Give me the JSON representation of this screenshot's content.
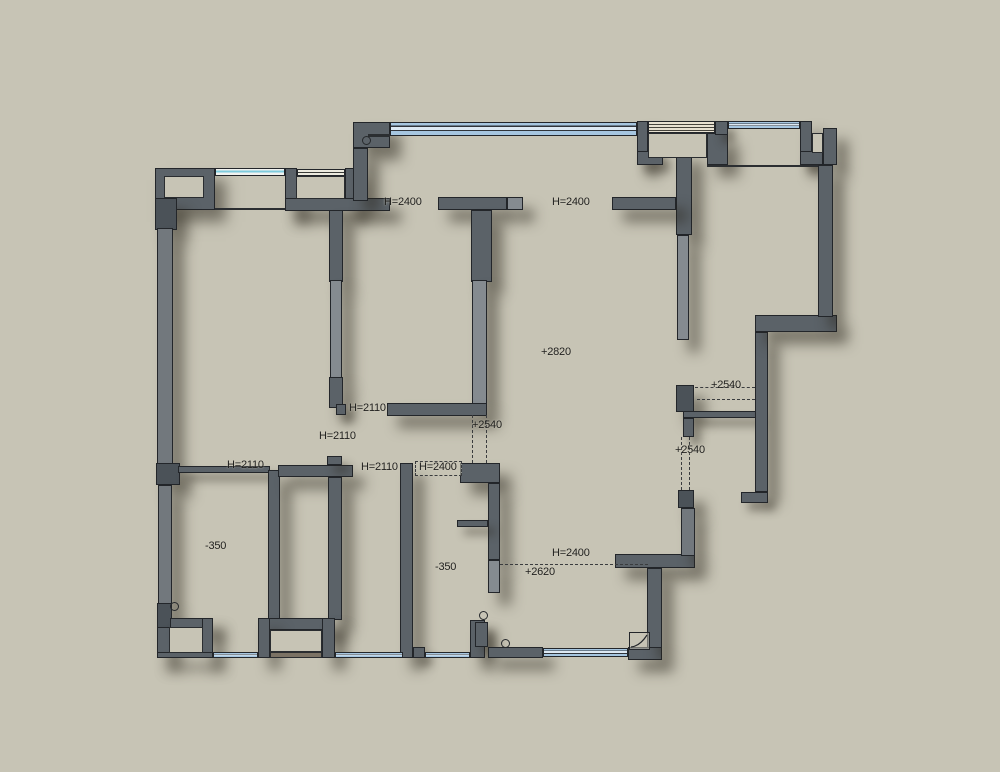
{
  "floorplan": {
    "type": "apartment-floor-plan",
    "palette": {
      "background": "#c7c4b5",
      "wall": "#5b6268",
      "wall_light": "#858b90",
      "wall_dark": "#4b5258",
      "window": "#a6c6e0",
      "text": "#1f1f1d"
    },
    "labels": [
      {
        "text": "H=2400",
        "x": 384,
        "y": 196
      },
      {
        "text": "H=2400",
        "x": 552,
        "y": 196
      },
      {
        "text": "+2820",
        "x": 541,
        "y": 346
      },
      {
        "text": "+2540",
        "x": 711,
        "y": 379
      },
      {
        "text": "H=2110",
        "x": 349,
        "y": 402
      },
      {
        "text": "+2540",
        "x": 472,
        "y": 419
      },
      {
        "text": "H=2110",
        "x": 319,
        "y": 430
      },
      {
        "text": "+2540",
        "x": 675,
        "y": 444
      },
      {
        "text": "H=2110",
        "x": 227,
        "y": 459
      },
      {
        "text": "H=2110",
        "x": 361,
        "y": 461
      },
      {
        "text": "H=2400",
        "x": 419,
        "y": 461
      },
      {
        "text": "-350",
        "x": 205,
        "y": 540
      },
      {
        "text": "H=2400",
        "x": 552,
        "y": 547
      },
      {
        "text": "+2620",
        "x": 525,
        "y": 566
      },
      {
        "text": "-350",
        "x": 435,
        "y": 561
      }
    ]
  }
}
